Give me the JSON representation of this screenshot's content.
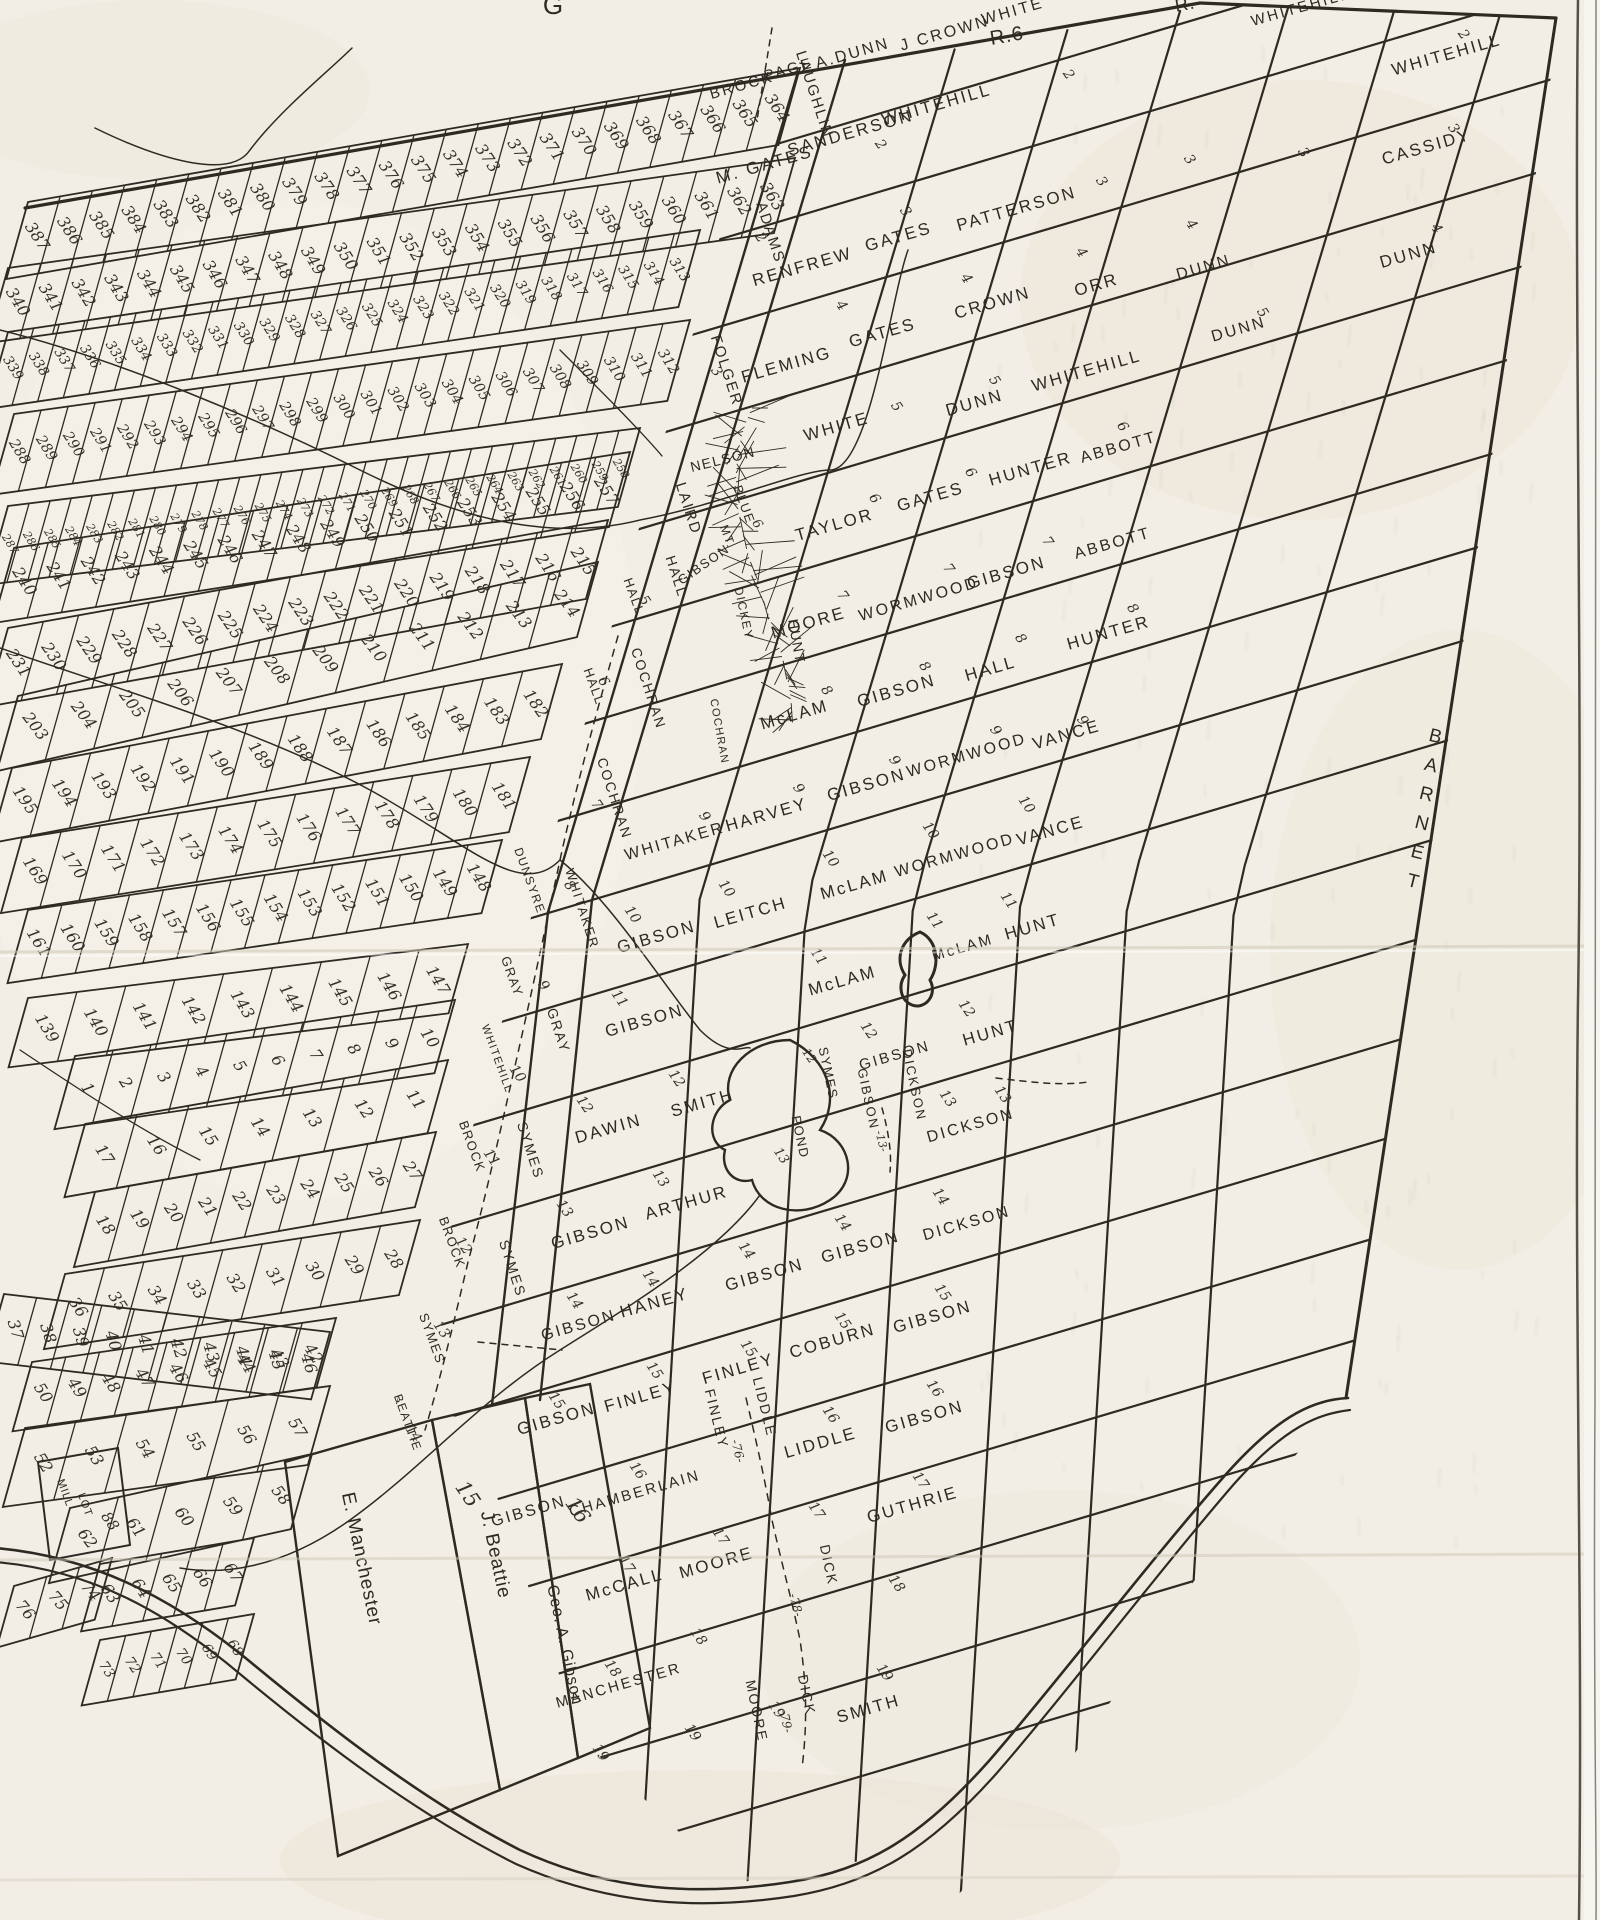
{
  "edge_labels": {
    "top_fragment": "G",
    "range_label": "R.6",
    "range_label_partial": "R.",
    "neighbor_town": "BARNET"
  },
  "grid_names": [
    [
      "BROCK",
      743,
      90,
      15
    ],
    [
      "PAGE",
      790,
      74,
      15
    ],
    [
      "A.DUNN",
      854,
      58,
      16
    ],
    [
      "J CROWN",
      946,
      38,
      16
    ],
    [
      "WHITE",
      1014,
      16,
      16
    ],
    [
      "WHITEHILL",
      1302,
      12,
      15
    ],
    [
      "M. GATES",
      766,
      170,
      17
    ],
    [
      "SANDERSON",
      852,
      138,
      17
    ],
    [
      "WHITEHILL",
      938,
      110,
      17
    ],
    [
      "WHITEHILL",
      1448,
      60,
      17
    ],
    [
      "RENFREW",
      804,
      272,
      17
    ],
    [
      "GATES",
      900,
      242,
      17
    ],
    [
      "PATTERSON",
      1018,
      214,
      17
    ],
    [
      "CASSIDY",
      1428,
      152,
      17
    ],
    [
      "FLEMING",
      788,
      370,
      17
    ],
    [
      "GATES",
      884,
      338,
      17
    ],
    [
      "CROWN",
      994,
      308,
      17
    ],
    [
      "ORR",
      1098,
      290,
      17
    ],
    [
      "DUNN",
      1205,
      272,
      16
    ],
    [
      "DUNN",
      1410,
      260,
      17
    ],
    [
      "WHITE",
      838,
      432,
      17
    ],
    [
      "DUNN",
      976,
      408,
      17
    ],
    [
      "WHITEHILL",
      1088,
      376,
      17
    ],
    [
      "DUNN",
      1240,
      334,
      16
    ],
    [
      "TAYLOR",
      836,
      530,
      17
    ],
    [
      "GATES",
      932,
      502,
      17
    ],
    [
      "HUNTER",
      1032,
      474,
      17
    ],
    [
      "ABBOTT",
      1120,
      452,
      16
    ],
    [
      "MOORE",
      810,
      628,
      17
    ],
    [
      "WORMWOOD",
      920,
      604,
      16
    ],
    [
      "GIBSON",
      1008,
      578,
      17
    ],
    [
      "ABBOTT",
      1114,
      548,
      16
    ],
    [
      "McLAM",
      796,
      720,
      17
    ],
    [
      "GIBSON",
      898,
      696,
      17
    ],
    [
      "HALL",
      992,
      674,
      17
    ],
    [
      "HUNTER",
      1110,
      638,
      17
    ],
    [
      "WHITAKER",
      676,
      846,
      16
    ],
    [
      "HARVEY",
      768,
      820,
      17
    ],
    [
      "GIBSON",
      868,
      790,
      17
    ],
    [
      "WORMWOOD",
      968,
      760,
      16
    ],
    [
      "VANCE",
      1068,
      740,
      17
    ],
    [
      "GIBSON",
      658,
      942,
      17
    ],
    [
      "LEITCH",
      752,
      918,
      17
    ],
    [
      "McLAM",
      856,
      890,
      17
    ],
    [
      "WORMWOOD",
      956,
      860,
      16
    ],
    [
      "VANCE",
      1052,
      836,
      17
    ],
    [
      "GIBSON",
      646,
      1026,
      17
    ],
    [
      "McLAM",
      844,
      986,
      17
    ],
    [
      "McLAM",
      964,
      952,
      15
    ],
    [
      "HUNT",
      1034,
      932,
      17
    ],
    [
      "DAWIN",
      610,
      1134,
      17
    ],
    [
      "SMITH",
      704,
      1108,
      17
    ],
    [
      "GIBSON",
      896,
      1060,
      15
    ],
    [
      "HUNT",
      992,
      1038,
      17
    ],
    [
      "GIBSON",
      592,
      1238,
      17
    ],
    [
      "ARTHUR",
      688,
      1208,
      17
    ],
    [
      "DICKSON",
      972,
      1130,
      16
    ],
    [
      "GIBSON",
      580,
      1330,
      16
    ],
    [
      "HANEY",
      656,
      1308,
      17
    ],
    [
      "GIBSON",
      766,
      1280,
      17
    ],
    [
      "GIBSON",
      862,
      1252,
      17
    ],
    [
      "DICKSON",
      968,
      1228,
      16
    ],
    [
      "GIBSON",
      558,
      1424,
      17
    ],
    [
      "FINLEY",
      642,
      1402,
      17
    ],
    [
      "FINLEY",
      740,
      1374,
      17
    ],
    [
      "COBURN",
      834,
      1346,
      17
    ],
    [
      "GIBSON",
      934,
      1322,
      17
    ],
    [
      "GIBSON",
      530,
      1516,
      16
    ],
    [
      "LIDDLE",
      822,
      1448,
      17
    ],
    [
      "GIBSON",
      926,
      1422,
      17
    ],
    [
      "CHAMBERLAIN",
      636,
      1498,
      15
    ],
    [
      "GUTHRIE",
      914,
      1510,
      17
    ],
    [
      "McCALL",
      626,
      1590,
      17
    ],
    [
      "MOORE",
      718,
      1568,
      17
    ],
    [
      "MANCHESTER",
      620,
      1690,
      15
    ],
    [
      "SMITH",
      870,
      1714,
      17
    ]
  ],
  "vertical_names": [
    [
      "FINLEY",
      712,
      1420,
      14,
      76
    ],
    [
      "LIDDLE",
      760,
      1408,
      14,
      76
    ],
    [
      "DICK",
      824,
      1566,
      14,
      78
    ],
    [
      "MOORE",
      752,
      1712,
      14,
      78
    ],
    [
      "DICK",
      802,
      1696,
      14,
      78
    ],
    [
      "GIBSON",
      864,
      1100,
      13,
      78
    ],
    [
      "DICKSON",
      910,
      1086,
      13,
      78
    ]
  ],
  "tier_names": [
    [
      "LAUGHLIN",
      810,
      96,
      15
    ],
    [
      "ADAMS",
      766,
      234,
      15
    ],
    [
      "FOLGER",
      722,
      372,
      15
    ],
    [
      "LAIRD",
      684,
      510,
      15
    ],
    [
      "HALL",
      672,
      578,
      14
    ],
    [
      "COCHRAN",
      644,
      690,
      14
    ],
    [
      "COCHRAN",
      610,
      800,
      14
    ],
    [
      "WHITAKER",
      578,
      910,
      13
    ],
    [
      "GRAY",
      554,
      1032,
      14
    ],
    [
      "SYMES",
      526,
      1152,
      14
    ],
    [
      "SYMES",
      508,
      1270,
      14
    ]
  ],
  "leftcol_names": [
    [
      "HALL",
      630,
      598,
      13
    ],
    [
      "HALL",
      590,
      688,
      13
    ],
    [
      "DUNSYRE",
      526,
      882,
      12
    ],
    [
      "GRAY",
      508,
      978,
      13
    ],
    [
      "WHITEHILL",
      494,
      1060,
      11
    ],
    [
      "BROCK",
      468,
      1148,
      13
    ],
    [
      "BROCK",
      448,
      1244,
      13
    ],
    [
      "SYMES",
      428,
      1340,
      13
    ],
    [
      "BEATTIE",
      404,
      1424,
      12
    ]
  ],
  "mountain_labels": [
    [
      "NELSON",
      724,
      464,
      14,
      -14
    ],
    [
      "BLUE",
      740,
      506,
      13,
      70
    ],
    [
      "MT.",
      724,
      538,
      12,
      70
    ],
    [
      "GIBSON",
      706,
      568,
      13,
      -35
    ],
    [
      "DICKEY",
      740,
      614,
      12,
      78
    ],
    [
      "HUNT",
      792,
      642,
      14,
      80
    ],
    [
      "COCHRAN",
      716,
      732,
      11,
      80
    ]
  ],
  "pond_labels": [
    [
      "SYMES",
      824,
      1074,
      13,
      78
    ],
    [
      "POND",
      796,
      1138,
      13,
      78
    ]
  ],
  "parcel_names": [
    [
      "E. Manchester",
      356,
      1560,
      19,
      78
    ],
    [
      "J. Beattie",
      490,
      1556,
      19,
      78
    ],
    [
      "Geo. A. Gibson",
      560,
      1646,
      16,
      78
    ],
    [
      "MILL",
      62,
      1494,
      11,
      70
    ],
    [
      "LOT",
      82,
      1506,
      11,
      70
    ]
  ],
  "road_labels": [
    [
      "-76-",
      734,
      1452,
      12,
      76
    ],
    [
      "-78-",
      792,
      1606,
      12,
      76
    ],
    [
      "-79-",
      782,
      1722,
      12,
      78
    ],
    [
      "-13-",
      878,
      1142,
      11,
      76
    ]
  ],
  "special_numbers": [
    [
      "15",
      462,
      1498,
      21
    ],
    [
      "16",
      572,
      1514,
      21
    ],
    [
      "88",
      106,
      1524,
      15
    ],
    [
      "6",
      754,
      526,
      13
    ],
    [
      "13",
      778,
      1158,
      13
    ],
    [
      "12",
      806,
      1058,
      12
    ]
  ],
  "range_marks": [
    [
      "2",
      757,
      240
    ],
    [
      "2",
      877,
      147
    ],
    [
      "2",
      1065,
      77
    ],
    [
      "2",
      1460,
      37
    ],
    [
      "3",
      713,
      374
    ],
    [
      "3",
      902,
      214
    ],
    [
      "3",
      1098,
      184
    ],
    [
      "3",
      1186,
      162
    ],
    [
      "3",
      1300,
      155
    ],
    [
      "3",
      1450,
      131
    ],
    [
      "4",
      838,
      308
    ],
    [
      "4",
      963,
      281
    ],
    [
      "4",
      1078,
      255
    ],
    [
      "4",
      1188,
      227
    ],
    [
      "4",
      1433,
      231
    ],
    [
      "5",
      641,
      603
    ],
    [
      "5",
      893,
      409
    ],
    [
      "5",
      991,
      383
    ],
    [
      "5",
      1259,
      315
    ],
    [
      "6",
      600,
      684
    ],
    [
      "6",
      871,
      501
    ],
    [
      "6",
      967,
      475
    ],
    [
      "6",
      1119,
      429
    ],
    [
      "7",
      593,
      807
    ],
    [
      "7",
      839,
      598
    ],
    [
      "7",
      945,
      571
    ],
    [
      "7",
      1044,
      544
    ],
    [
      "8",
      566,
      888
    ],
    [
      "8",
      823,
      693
    ],
    [
      "8",
      921,
      669
    ],
    [
      "8",
      1017,
      641
    ],
    [
      "8",
      1129,
      611
    ],
    [
      "9",
      540,
      988
    ],
    [
      "9",
      701,
      819
    ],
    [
      "9",
      795,
      791
    ],
    [
      "9",
      891,
      763
    ],
    [
      "9",
      992,
      733
    ],
    [
      "9",
      1079,
      723
    ],
    [
      "10",
      514,
      1076
    ],
    [
      "10",
      629,
      917
    ],
    [
      "10",
      723,
      891
    ],
    [
      "10",
      827,
      861
    ],
    [
      "10",
      927,
      833
    ],
    [
      "10",
      1023,
      807
    ],
    [
      "11",
      488,
      1160
    ],
    [
      "11",
      815,
      959
    ],
    [
      "11",
      931,
      923
    ],
    [
      "11",
      1005,
      903
    ],
    [
      "11",
      616,
      1001
    ],
    [
      "12",
      460,
      1248
    ],
    [
      "12",
      581,
      1107
    ],
    [
      "12",
      673,
      1081
    ],
    [
      "12",
      865,
      1033
    ],
    [
      "12",
      963,
      1011
    ],
    [
      "13",
      438,
      1332
    ],
    [
      "13",
      561,
      1211
    ],
    [
      "13",
      657,
      1181
    ],
    [
      "13",
      944,
      1101
    ],
    [
      "13",
      999,
      1097
    ],
    [
      "14",
      410,
      1436
    ],
    [
      "14",
      571,
      1303
    ],
    [
      "14",
      647,
      1281
    ],
    [
      "14",
      743,
      1253
    ],
    [
      "14",
      839,
      1225
    ],
    [
      "14",
      937,
      1199
    ],
    [
      "15",
      553,
      1403
    ],
    [
      "15",
      651,
      1373
    ],
    [
      "15",
      745,
      1351
    ],
    [
      "15",
      839,
      1323
    ],
    [
      "15",
      939,
      1295
    ],
    [
      "16",
      634,
      1473
    ],
    [
      "16",
      827,
      1417
    ],
    [
      "16",
      931,
      1391
    ],
    [
      "17",
      623,
      1567
    ],
    [
      "17",
      717,
      1539
    ],
    [
      "17",
      813,
      1513
    ],
    [
      "17",
      917,
      1483
    ],
    [
      "18",
      609,
      1671
    ],
    [
      "18",
      695,
      1639
    ],
    [
      "18",
      893,
      1586
    ],
    [
      "19",
      597,
      1755
    ],
    [
      "19",
      689,
      1735
    ],
    [
      "19",
      881,
      1675
    ],
    [
      "19",
      773,
      1712
    ]
  ],
  "strip_bands": [
    {
      "a": 387,
      "b": 364,
      "x1": 28,
      "y1": 202,
      "x2": 800,
      "y2": 68,
      "h": 80
    },
    {
      "a": 340,
      "b": 363,
      "x1": 8,
      "y1": 268,
      "x2": 795,
      "y2": 158,
      "h": 78
    },
    {
      "a": 339,
      "b": 313,
      "x1": 8,
      "y1": 332,
      "x2": 700,
      "y2": 230,
      "h": 80
    },
    {
      "a": 288,
      "b": 312,
      "x1": 14,
      "y1": 414,
      "x2": 690,
      "y2": 320,
      "h": 84
    },
    {
      "a": 287,
      "b": 258,
      "x1": 8,
      "y1": 506,
      "x2": 640,
      "y2": 428,
      "h": 82
    },
    {
      "a": 240,
      "b": 257,
      "x1": 14,
      "y1": 548,
      "x2": 630,
      "y2": 452,
      "h": 78
    },
    {
      "a": 231,
      "b": 215,
      "x1": 8,
      "y1": 628,
      "x2": 608,
      "y2": 520,
      "h": 82
    },
    {
      "a": 203,
      "b": 214,
      "x1": 18,
      "y1": 696,
      "x2": 598,
      "y2": 562,
      "h": 78
    },
    {
      "a": 195,
      "b": 182,
      "x1": 12,
      "y1": 768,
      "x2": 562,
      "y2": 664,
      "h": 78
    },
    {
      "a": 169,
      "b": 181,
      "x1": 22,
      "y1": 838,
      "x2": 530,
      "y2": 757,
      "h": 78
    },
    {
      "a": 161,
      "b": 148,
      "x1": 28,
      "y1": 910,
      "x2": 502,
      "y2": 840,
      "h": 76
    },
    {
      "a": 139,
      "b": 147,
      "x1": 28,
      "y1": 998,
      "x2": 468,
      "y2": 944,
      "h": 72
    },
    {
      "a": 1,
      "b": 10,
      "x1": 75,
      "y1": 1056,
      "x2": 455,
      "y2": 1000,
      "h": 76
    },
    {
      "a": 17,
      "b": 11,
      "x1": 85,
      "y1": 1124,
      "x2": 448,
      "y2": 1060,
      "h": 76
    },
    {
      "a": 18,
      "b": 27,
      "x1": 95,
      "y1": 1192,
      "x2": 436,
      "y2": 1132,
      "h": 78
    },
    {
      "a": 36,
      "b": 28,
      "x1": 65,
      "y1": 1274,
      "x2": 420,
      "y2": 1220,
      "h": 78
    },
    {
      "a": 37,
      "b": 46,
      "x1": 4,
      "y1": 1294,
      "x2": 330,
      "y2": 1332,
      "h": 70
    },
    {
      "a": 50,
      "b": 42,
      "x1": 32,
      "y1": 1362,
      "x2": 336,
      "y2": 1318,
      "h": 72
    },
    {
      "a": 52,
      "b": 57,
      "x1": 25,
      "y1": 1428,
      "x2": 330,
      "y2": 1386,
      "h": 82
    },
    {
      "a": 62,
      "b": 58,
      "x1": 70,
      "y1": 1508,
      "x2": 312,
      "y2": 1454,
      "h": 78
    },
    {
      "a": 63,
      "b": 67,
      "x1": 100,
      "y1": 1564,
      "x2": 254,
      "y2": 1538,
      "h": 70
    },
    {
      "a": 76,
      "b": 74,
      "x1": 14,
      "y1": 1586,
      "x2": 112,
      "y2": 1558,
      "h": 64
    },
    {
      "a": 73,
      "b": 68,
      "x1": 100,
      "y1": 1640,
      "x2": 254,
      "y2": 1614,
      "h": 68
    }
  ]
}
